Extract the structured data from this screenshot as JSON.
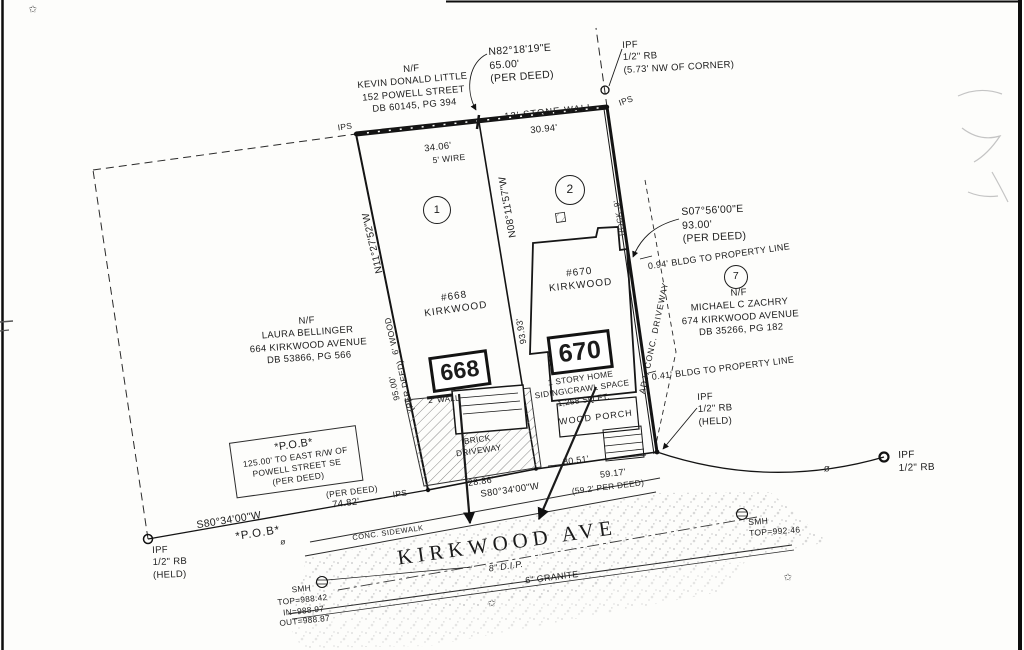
{
  "survey": {
    "owners": {
      "little": {
        "nf": "N/F",
        "name": "KEVIN DONALD LITTLE",
        "address": "152 POWELL STREET",
        "deed": "DB 60145, PG 394"
      },
      "bellinger": {
        "nf": "N/F",
        "name": "LAURA BELLINGER",
        "address": "664 KIRKWOOD AVENUE",
        "deed": "DB 53866, PG 566"
      },
      "zachry": {
        "nf": "N/F",
        "name": "MICHAEL C ZACHRY",
        "address": "674 KIRKWOOD AVENUE",
        "deed": "DB 35266, PG 182"
      }
    },
    "lots": {
      "lot1_no": "1",
      "lot2_no": "2",
      "lot7_no": "7",
      "lot1_house": "#668",
      "lot1_street": "KIRKWOOD",
      "lot1_box": "668",
      "lot2_house": "#670",
      "lot2_street": "KIRKWOOD",
      "lot2_box": "670",
      "home_line1": "1 STORY HOME",
      "home_line2": "SIDING\\CRAWL SPACE",
      "home_line3": "1,258 SQ.FT.",
      "porch": "WOOD PORCH",
      "brick1": "BRICK",
      "brick2": "DRIVEWAY",
      "wall2": "2' WALL"
    },
    "bearings": {
      "north": "N82°18'19\"E",
      "north_dist": "65.00'",
      "north_src": "(PER DEED)",
      "west": "N11°27'52\"W",
      "mid": "N08°11'57\"W",
      "east": "S07°56'00\"E",
      "east_dist": "93.00'",
      "east_src": "(PER DEED)",
      "front_left": "S80°34'00\"W",
      "front_mid": "S80°34'00\"W"
    },
    "dims": {
      "stone_wall": "12' STONE WALL",
      "wire": "5' WIRE",
      "d3406": "34.06'",
      "d3094": "30.94'",
      "wood6": "6' WOOD",
      "d9500": "95.00'",
      "d9500_src": "(PER DEED)",
      "d9393": "93.93'",
      "d7482": "74.82'",
      "d7482_src": "(PER DEED)",
      "d2886": "28.86'",
      "d3051": "30.51'",
      "d5917": "59.17'",
      "d5917_src": "(59.2' PER DEED)",
      "bldg_094": "0.94' BLDG TO PROPERTY LINE",
      "bldg_041": "0.41' BLDG TO PROPERTY LINE",
      "rock": "ROCK .9'"
    },
    "markers": {
      "ips": "IPS",
      "ipf": "IPF",
      "rb": "1/2\" RB",
      "held": "(HELD)",
      "nw_corner": "(5.73' NW OF CORNER)",
      "smh": "SMH",
      "smh_e_top": "TOP=992.46",
      "smh_w_top": "TOP=988.42",
      "smh_w_in": "IN=988.97",
      "smh_w_out": "OUT=988.87",
      "phi": "ø",
      "star": "✩"
    },
    "pob": {
      "title": "*P.O.B*",
      "line2": "125.00' TO EAST R/W OF",
      "line3": "POWELL STREET SE",
      "line4": "(PER DEED)",
      "corner": "*P.O.B*"
    },
    "street": {
      "name": "KIRKWOOD AVE",
      "pipe": "8\" D.I.P.",
      "curb": "6\" GRANITE",
      "sidewalk": "CONC. SIDEWALK",
      "adj_driveway": "ADJ. CONC. DRIVEWAY"
    }
  }
}
